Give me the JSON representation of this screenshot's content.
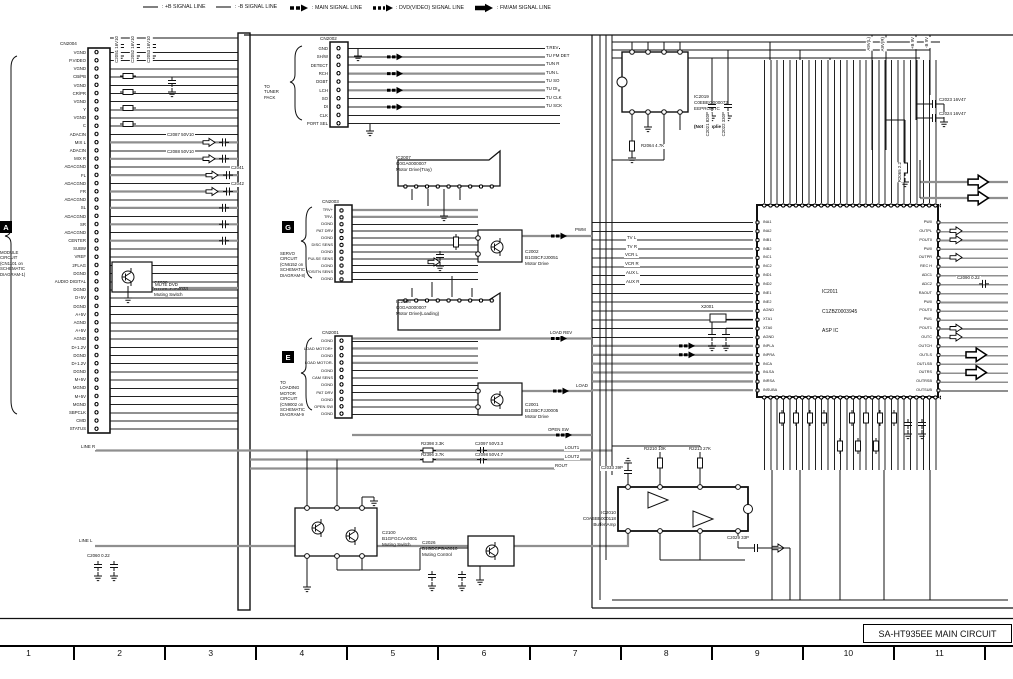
{
  "legend": {
    "items": [
      {
        "label": ": +B SIGNAL LINE"
      },
      {
        "label": ": -B SIGNAL LINE"
      },
      {
        "label": ": MAIN SIGNAL LINE"
      },
      {
        "label": ": DVD(VIDEO) SIGNAL LINE"
      },
      {
        "label": ": FM/AM SIGNAL LINE"
      }
    ]
  },
  "page": {
    "title": "SA-HT935EE MAIN CIRCUIT",
    "ruler": [
      "1",
      "2",
      "3",
      "4",
      "5",
      "6",
      "7",
      "8",
      "9",
      "10",
      "11"
    ]
  },
  "module_a": {
    "tag": "A",
    "lines": [
      "MODULE",
      "CIRCUIT",
      "(CN1101 on",
      "SCHEMATIC",
      "DIAGRAM-1)"
    ]
  },
  "cn2004": {
    "ref": "CN2004",
    "pins": [
      "VGND",
      "P.VIDEO",
      "VGND",
      "CB/PB",
      "VGND",
      "CR/PR",
      "VGND",
      "Y",
      "VGND",
      "C",
      "ADACIN",
      "MIX L",
      "ADACIN",
      "MIX R",
      "ADACGND",
      "FL",
      "ADACGND",
      "FR",
      "ADACGND",
      "SL",
      "ADACGND",
      "SR",
      "ADACGND",
      "CENTER",
      "SUBW",
      "VREF",
      "2FLAG",
      "DGND",
      "AUDIO DIGITAL",
      "DGND",
      "D+5V",
      "DGND",
      "A+5V",
      "AGND",
      "A+5V",
      "AGND",
      "D+1.2V",
      "DGND",
      "D+1.2V",
      "DGND",
      "M+5V",
      "MGND",
      "M+5V",
      "MGND",
      "SBPCLK",
      "CMD",
      "STATUS"
    ]
  },
  "cn2002": {
    "ref": "CN2002",
    "bracket": [
      "TO",
      "TUNER",
      "PACK"
    ],
    "pins": [
      "GND",
      "SH/W",
      "DETECT",
      "RCH",
      "DGBT",
      "LCH",
      "SO",
      "DI",
      "CLK",
      "PORT SEL"
    ],
    "right_labels": [
      {
        "label": "T.REV",
        "x": 545,
        "y": 45.5
      },
      {
        "label": "TU FM DET",
        "x": 545,
        "y": 53.9
      },
      {
        "label": "TUN R",
        "x": 545,
        "y": 62.2
      },
      {
        "label": "TUN L",
        "x": 545,
        "y": 70.6
      },
      {
        "label": "TU SO",
        "x": 545,
        "y": 78.9
      },
      {
        "label": "TU DI",
        "x": 545,
        "y": 87.3
      },
      {
        "label": "TU CLK",
        "x": 545,
        "y": 95.6
      },
      {
        "label": "TU SCK",
        "x": 545,
        "y": 104
      }
    ]
  },
  "cn2003": {
    "ref": "CN2003",
    "tag": "G",
    "note": [
      "SERVO",
      "CIRCUIT",
      "(CN6152 on",
      "SCHEMATIC",
      "DIAGRAM-8)"
    ],
    "pins": [
      "TRV+",
      "TRV-",
      "DGND",
      "PAT DRV",
      "DGND",
      "DISC SENS",
      "DGND",
      "PULSE SENS",
      "DGND",
      "POSITN SENS",
      "DGND"
    ]
  },
  "cn2001": {
    "ref": "CN2001",
    "tag": "E",
    "note": [
      "TO",
      "LOADING",
      "MOTOR",
      "CIRCUIT",
      "(CN9002 on",
      "SCHEMATIC",
      "DIAGRAM-9"
    ],
    "pins": [
      "DGND",
      "LOAD MOTOR+",
      "DGND",
      "LOAD MOTOR-",
      "DGND",
      "CAM SENS",
      "DGND",
      "PAT DRV",
      "DGND",
      "OPEN SW",
      "DGND"
    ]
  },
  "ic2007": {
    "lines": [
      "IC2007",
      "C0GA0000007",
      "Motor Drive(Tray)"
    ]
  },
  "ic2006": {
    "lines": [
      "IC2006",
      "C0GA0000007",
      "Motor Drive(Loading)"
    ]
  },
  "ic2019": {
    "lines": [
      "IC2019",
      "C0EBEG000072",
      "EEPROM IC"
    ],
    "note": "(Not Supplied)"
  },
  "ic2010": {
    "lines": [
      "IC2010",
      "C0ABBB000118",
      "Buffer Amp"
    ]
  },
  "q2002": {
    "lines": [
      "C2002",
      "B1GBCFJJ0051",
      "Motor Drive"
    ]
  },
  "q2001": {
    "lines": [
      "C2001",
      "B1GBCFJJ0005",
      "Motor Drive"
    ]
  },
  "q2038": {
    "lines": [
      "C2038",
      "B1GBCFJA0033",
      "Muting Switch"
    ]
  },
  "q2100": {
    "lines": [
      "C2100",
      "B1GFGCAA0001",
      "Muting Switch"
    ]
  },
  "q2026": {
    "lines": [
      "C2026",
      "B1GDCFGA0010",
      "Muting Control"
    ]
  },
  "ic2011": {
    "ref": "IC2011",
    "part": "C1ZBZ0003945",
    "desc": "ASP IC",
    "left_pins": [
      "INA1",
      "INA2",
      "INB1",
      "INB2",
      "INC1",
      "INC2",
      "IND1",
      "IND2",
      "INE1",
      "INE2",
      "AGND",
      "XTA1",
      "XTA0",
      "AGND",
      "INPLA",
      "INPRA",
      "INCA",
      "INLSA",
      "INRSA",
      "INSUBA"
    ],
    "right_pins": [
      "PW0",
      "OUTPL",
      "POUT0",
      "PW0",
      "OUTPR",
      "REC H",
      "ADC1",
      "ADC2",
      "RAOUT",
      "PW0",
      "POUT0",
      "PW1",
      "POUT1",
      "OUTC",
      "OUTCH",
      "OUTLS",
      "OUTLSB",
      "OUTRS",
      "OUTRSB",
      "OUTSUB"
    ]
  },
  "signals": [
    {
      "label": "MUTE DVD",
      "x": 154,
      "y": 283
    },
    {
      "label": "PWM",
      "x": 574,
      "y": 228
    },
    {
      "label": "LOAD REV",
      "x": 549,
      "y": 331
    },
    {
      "label": "LOAD",
      "x": 575,
      "y": 384
    },
    {
      "label": "OPEN SW",
      "x": 547,
      "y": 428
    },
    {
      "label": "LINE R",
      "x": 80,
      "y": 445
    },
    {
      "label": "LINE L",
      "x": 78,
      "y": 539
    },
    {
      "label": "LOUT1",
      "x": 564,
      "y": 446
    },
    {
      "label": "LOUT2",
      "x": 564,
      "y": 455
    },
    {
      "label": "ROUT",
      "x": 554,
      "y": 464
    },
    {
      "label": "TV L",
      "x": 626,
      "y": 236
    },
    {
      "label": "TV R",
      "x": 626,
      "y": 245
    },
    {
      "label": "VCR L",
      "x": 624,
      "y": 253
    },
    {
      "label": "VCR R",
      "x": 624,
      "y": 262
    },
    {
      "label": "AUX L",
      "x": 625,
      "y": 271
    },
    {
      "label": "AUX R",
      "x": 625,
      "y": 280
    }
  ],
  "parts": [
    {
      "label": "C2051 16V10",
      "x": 114,
      "y": 36,
      "rot": true
    },
    {
      "label": "C2052 16V10",
      "x": 130,
      "y": 36,
      "rot": true
    },
    {
      "label": "C2053 16V10",
      "x": 146,
      "y": 36,
      "rot": true
    },
    {
      "label": "C2087 50V10",
      "x": 166,
      "y": 133
    },
    {
      "label": "C2088 50V10",
      "x": 166,
      "y": 150
    },
    {
      "label": "C2041",
      "x": 230,
      "y": 166
    },
    {
      "label": "C2042",
      "x": 230,
      "y": 182
    },
    {
      "label": "R2064 4.7K",
      "x": 640,
      "y": 144
    },
    {
      "label": "C2021 820P",
      "x": 705,
      "y": 112,
      "rot": true
    },
    {
      "label": "C2022 330P",
      "x": 721,
      "y": 112,
      "rot": true
    },
    {
      "label": "C2023 16V47",
      "x": 938,
      "y": 98
    },
    {
      "label": "C2024 16V47",
      "x": 938,
      "y": 112
    },
    {
      "label": "A9V(L)",
      "x": 866,
      "y": 37,
      "rot": true
    },
    {
      "label": "A9V(R)",
      "x": 880,
      "y": 37,
      "rot": true
    },
    {
      "label": "+B 9V",
      "x": 910,
      "y": 37,
      "rot": true
    },
    {
      "label": "-B 9V",
      "x": 924,
      "y": 37,
      "rot": true
    },
    {
      "label": "R2065 2.2",
      "x": 897,
      "y": 162,
      "rot": true
    },
    {
      "label": "X2001",
      "x": 700,
      "y": 305
    },
    {
      "label": "R2398 3.3K",
      "x": 420,
      "y": 442
    },
    {
      "label": "C2097 50V3.3",
      "x": 474,
      "y": 442
    },
    {
      "label": "R2396 3.7K",
      "x": 420,
      "y": 453
    },
    {
      "label": "C2098 50V4.7",
      "x": 474,
      "y": 453
    },
    {
      "label": "R2210 10K",
      "x": 643,
      "y": 447
    },
    {
      "label": "R2213 27K",
      "x": 688,
      "y": 447
    },
    {
      "label": "C2033 39P",
      "x": 600,
      "y": 466
    },
    {
      "label": "C2029 33P",
      "x": 726,
      "y": 536
    },
    {
      "label": "C2060 0.22",
      "x": 86,
      "y": 554
    },
    {
      "label": "C2090 0.22",
      "x": 956,
      "y": 276
    }
  ]
}
